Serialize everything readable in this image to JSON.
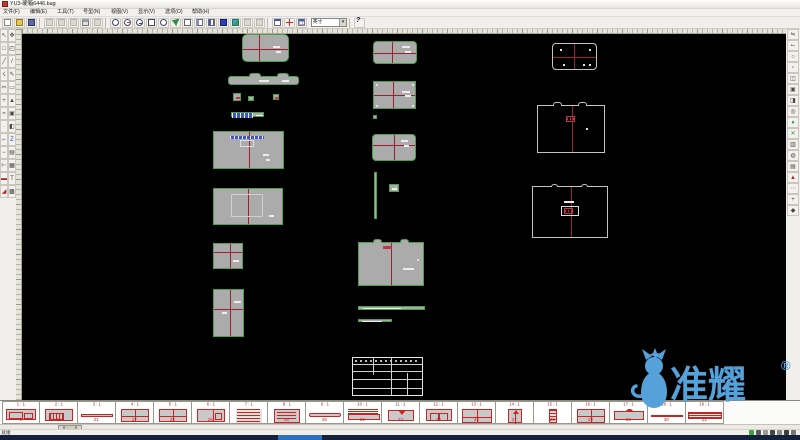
{
  "window": {
    "title": "YU3-硬箱6446.bag"
  },
  "menu": {
    "items": [
      "文件(F)",
      "编辑(E)",
      "工具(T)",
      "号型(N)",
      "视图(V)",
      "显示(V)",
      "选项(O)",
      "帮助(H)"
    ]
  },
  "toolbar": {
    "unit_value": "英寸",
    "buttons": [
      {
        "s": "i-page",
        "n": "new-file-icon"
      },
      {
        "s": "i-folder",
        "n": "open-file-icon"
      },
      {
        "s": "i-floppy",
        "n": "save-file-icon"
      },
      {
        "sep": true
      },
      {
        "s": "i-gray",
        "n": "cut-icon"
      },
      {
        "s": "i-gray",
        "n": "copy-icon"
      },
      {
        "s": "i-gray",
        "n": "paste-icon"
      },
      {
        "s": "i-print",
        "n": "print-icon"
      },
      {
        "s": "i-gray",
        "n": "undo-icon"
      },
      {
        "sep": true
      },
      {
        "s": "i-mag",
        "n": "zoom-icon"
      },
      {
        "s": "i-magp",
        "n": "zoom-in-icon"
      },
      {
        "s": "i-magm",
        "n": "zoom-out-icon"
      },
      {
        "s": "i-magw",
        "n": "zoom-window-icon"
      },
      {
        "s": "i-mag",
        "n": "zoom-all-icon"
      },
      {
        "s": "i-green",
        "n": "pan-icon"
      },
      {
        "s": "i-frame",
        "n": "frame-view-icon"
      },
      {
        "s": "i-frame2",
        "n": "split-view-icon"
      },
      {
        "s": "i-cols",
        "n": "columns-view-icon"
      },
      {
        "s": "i-blue",
        "n": "fill-view-icon"
      },
      {
        "s": "i-pic",
        "n": "layer-view-icon"
      },
      {
        "s": "i-gray",
        "n": "disabled-tool-icon"
      },
      {
        "s": "i-gray",
        "n": "disabled-tool2-icon"
      },
      {
        "sep": true
      },
      {
        "s": "i-win",
        "n": "new-window-icon"
      },
      {
        "s": "i-plus",
        "n": "add-mark-icon"
      },
      {
        "s": "i-grid",
        "n": "size-table-icon"
      }
    ]
  },
  "left_toolbar": {
    "icons": [
      "↖",
      "✥",
      "□",
      "◰",
      "╱",
      "/",
      "☇",
      "✎",
      "✂",
      "▭",
      "+",
      "▲",
      "≈",
      "▣",
      "·",
      "◧",
      "⌐",
      "Z",
      "−",
      "▤",
      "⊢",
      "▦",
      "▬",
      "T",
      "◢",
      "▩"
    ]
  },
  "right_toolbar": {
    "icons": [
      "≒",
      "⌙",
      "○",
      "▫",
      "◫",
      "▣",
      "◨",
      "◎",
      "♦",
      "✕",
      "▥",
      "◍",
      "▤",
      "▲",
      "⋯",
      "+",
      "◆"
    ]
  },
  "canvas": {
    "pieces": [
      {
        "name": "piece-lid-top",
        "kind": "filled",
        "x": 220,
        "y": 0,
        "w": 47,
        "h": 28,
        "r": 5,
        "cross": "vh",
        "cx": 16,
        "cy": 14,
        "det": [
          {
            "t": "dash",
            "x": 30,
            "y": 11,
            "w": 7,
            "h": 2
          },
          {
            "t": "dash",
            "x": 33,
            "y": 16,
            "w": 5,
            "h": 2
          }
        ]
      },
      {
        "name": "piece-flap-strip",
        "kind": "filled",
        "x": 206,
        "y": 42,
        "w": 71,
        "h": 9,
        "r": 3,
        "cross": "",
        "det": [
          {
            "t": "bump",
            "x": 20,
            "y": -4,
            "w": 12,
            "h": 4
          },
          {
            "t": "bump",
            "x": 48,
            "y": -4,
            "w": 12,
            "h": 4
          },
          {
            "t": "dash",
            "x": 30,
            "y": 3,
            "w": 10,
            "h": 2
          },
          {
            "t": "dash",
            "x": 53,
            "y": 3,
            "w": 7,
            "h": 2
          }
        ]
      },
      {
        "name": "piece-small-1",
        "kind": "filled",
        "x": 211,
        "y": 59,
        "w": 8,
        "h": 8,
        "r": 0,
        "cross": "",
        "det": [
          {
            "t": "reddash",
            "x": 2,
            "y": 3,
            "w": 4,
            "h": 2
          }
        ]
      },
      {
        "name": "piece-small-2",
        "kind": "filled",
        "x": 226,
        "y": 62,
        "w": 6,
        "h": 5,
        "r": 0,
        "cross": "",
        "det": []
      },
      {
        "name": "piece-small-3",
        "kind": "filled",
        "x": 251,
        "y": 60,
        "w": 6,
        "h": 6,
        "r": 0,
        "cross": "",
        "det": [
          {
            "t": "reddash",
            "x": 1,
            "y": 2,
            "w": 3,
            "h": 2
          }
        ]
      },
      {
        "name": "piece-label-bar",
        "kind": "filled",
        "x": 209,
        "y": 78,
        "w": 33,
        "h": 5,
        "r": 0,
        "cross": "",
        "det": [
          {
            "t": "bluebar",
            "x": 0,
            "y": 0,
            "w": 21,
            "h": 5
          },
          {
            "t": "dash",
            "x": 24,
            "y": 2,
            "w": 7,
            "h": 1
          }
        ]
      },
      {
        "name": "piece-body-front",
        "kind": "filled",
        "x": 191,
        "y": 97,
        "w": 71,
        "h": 38,
        "r": 0,
        "cross": "v",
        "cx": 35,
        "cy": 0,
        "det": [
          {
            "t": "bluebar",
            "x": 16,
            "y": 4,
            "w": 34,
            "h": 3
          },
          {
            "t": "whitebox",
            "x": 26,
            "y": 8,
            "w": 14,
            "h": 7
          },
          {
            "t": "dash",
            "x": 49,
            "y": 22,
            "w": 6,
            "h": 2
          },
          {
            "t": "dash",
            "x": 52,
            "y": 27,
            "w": 4,
            "h": 2
          }
        ]
      },
      {
        "name": "piece-body-back",
        "kind": "filled",
        "x": 191,
        "y": 154,
        "w": 70,
        "h": 37,
        "r": 0,
        "cross": "v",
        "cx": 34,
        "cy": 0,
        "det": [
          {
            "t": "innerrect",
            "x": 17,
            "y": 5,
            "w": 32,
            "h": 23
          },
          {
            "t": "dash",
            "x": 55,
            "y": 26,
            "w": 5,
            "h": 2
          }
        ]
      },
      {
        "name": "piece-side-small",
        "kind": "filled",
        "x": 191,
        "y": 209,
        "w": 30,
        "h": 26,
        "r": 0,
        "cross": "vh",
        "cx": 16,
        "cy": 8,
        "det": [
          {
            "t": "dash",
            "x": 19,
            "y": 16,
            "w": 6,
            "h": 2
          }
        ]
      },
      {
        "name": "piece-side-tall",
        "kind": "filled",
        "x": 191,
        "y": 255,
        "w": 31,
        "h": 48,
        "r": 0,
        "cross": "vh",
        "cx": 16,
        "cy": 19,
        "det": [
          {
            "t": "dash",
            "x": 20,
            "y": 11,
            "w": 7,
            "h": 2
          },
          {
            "t": "dash",
            "x": 8,
            "y": 22,
            "w": 5,
            "h": 2
          }
        ]
      },
      {
        "name": "piece-mid-lid",
        "kind": "filled",
        "x": 351,
        "y": 7,
        "w": 44,
        "h": 23,
        "r": 4,
        "cross": "vh",
        "cx": 18,
        "cy": 11,
        "det": [
          {
            "t": "dash",
            "x": 28,
            "y": 4,
            "w": 8,
            "h": 2
          },
          {
            "t": "dash",
            "x": 31,
            "y": 9,
            "w": 6,
            "h": 2
          }
        ]
      },
      {
        "name": "piece-mid-panel",
        "kind": "filled",
        "x": 351,
        "y": 47,
        "w": 43,
        "h": 28,
        "r": 0,
        "cross": "vh",
        "cx": 19,
        "cy": 13,
        "det": [
          {
            "t": "dash",
            "x": 28,
            "y": 9,
            "w": 8,
            "h": 2
          },
          {
            "t": "dash",
            "x": 31,
            "y": 13,
            "w": 6,
            "h": 2
          },
          {
            "t": "dot",
            "x": 2,
            "y": 2,
            "w": 2,
            "h": 2
          },
          {
            "t": "dot",
            "x": 38,
            "y": 2,
            "w": 2,
            "h": 2
          },
          {
            "t": "dot",
            "x": 2,
            "y": 23,
            "w": 2,
            "h": 2
          },
          {
            "t": "dot",
            "x": 38,
            "y": 23,
            "w": 2,
            "h": 2
          }
        ]
      },
      {
        "name": "piece-tiny-square",
        "kind": "filled",
        "x": 351,
        "y": 81,
        "w": 4,
        "h": 4,
        "r": 0,
        "cross": "",
        "det": []
      },
      {
        "name": "piece-mid-lid2",
        "kind": "filled",
        "x": 350,
        "y": 100,
        "w": 44,
        "h": 27,
        "r": 4,
        "cross": "vh",
        "cx": 21,
        "cy": 10,
        "det": [
          {
            "t": "dash",
            "x": 28,
            "y": 5,
            "w": 7,
            "h": 2
          },
          {
            "t": "dash",
            "x": 31,
            "y": 10,
            "w": 5,
            "h": 2
          }
        ]
      },
      {
        "name": "piece-thin-vertical",
        "kind": "filled",
        "x": 352,
        "y": 138,
        "w": 3,
        "h": 47,
        "r": 0,
        "cross": "",
        "det": []
      },
      {
        "name": "piece-tiny-tab",
        "kind": "filled",
        "x": 367,
        "y": 150,
        "w": 10,
        "h": 8,
        "r": 0,
        "cross": "",
        "det": [
          {
            "t": "dash",
            "x": 2,
            "y": 3,
            "w": 5,
            "h": 2
          }
        ]
      },
      {
        "name": "piece-gusset",
        "kind": "filled",
        "x": 336,
        "y": 208,
        "w": 66,
        "h": 44,
        "r": 0,
        "cross": "v",
        "cx": 32,
        "cy": 0,
        "det": [
          {
            "t": "bump",
            "x": 14,
            "y": -4,
            "w": 9,
            "h": 4
          },
          {
            "t": "bump",
            "x": 41,
            "y": -4,
            "w": 9,
            "h": 4
          },
          {
            "t": "reddash",
            "x": 24,
            "y": 3,
            "w": 9,
            "h": 3
          },
          {
            "t": "dash",
            "x": 44,
            "y": 25,
            "w": 11,
            "h": 2
          },
          {
            "t": "dot",
            "x": 58,
            "y": 16,
            "w": 2,
            "h": 2
          }
        ]
      },
      {
        "name": "piece-long-strip",
        "kind": "filled",
        "x": 336,
        "y": 272,
        "w": 67,
        "h": 4,
        "r": 0,
        "cross": "",
        "det": [
          {
            "t": "dash",
            "x": 4,
            "y": 1,
            "w": 38,
            "h": 1
          }
        ]
      },
      {
        "name": "piece-short-strip",
        "kind": "filled",
        "x": 336,
        "y": 285,
        "w": 34,
        "h": 3,
        "r": 0,
        "cross": "",
        "det": [
          {
            "t": "dash",
            "x": 3,
            "y": 1,
            "w": 20,
            "h": 1
          }
        ]
      },
      {
        "name": "title-block",
        "kind": "tblock",
        "x": 330,
        "y": 323,
        "w": 71,
        "h": 39,
        "r": 0,
        "cross": "",
        "det": []
      },
      {
        "name": "piece-outline-lid",
        "kind": "outline",
        "x": 530,
        "y": 9,
        "w": 45,
        "h": 27,
        "r": 4,
        "cross": "vh",
        "cx": 21,
        "cy": 13,
        "det": [
          {
            "t": "dot",
            "x": 7,
            "y": 5,
            "w": 2,
            "h": 2
          },
          {
            "t": "dot",
            "x": 36,
            "y": 5,
            "w": 2,
            "h": 2
          },
          {
            "t": "dot",
            "x": 10,
            "y": 20,
            "w": 2,
            "h": 2
          },
          {
            "t": "dot",
            "x": 30,
            "y": 20,
            "w": 2,
            "h": 2
          },
          {
            "t": "dot",
            "x": 36,
            "y": 20,
            "w": 2,
            "h": 2
          }
        ]
      },
      {
        "name": "piece-outline-box1",
        "kind": "outline",
        "x": 515,
        "y": 71,
        "w": 68,
        "h": 48,
        "r": 0,
        "cross": "v",
        "cx": 34,
        "cy": 0,
        "det": [
          {
            "t": "obump",
            "x": 15,
            "y": -4,
            "w": 9,
            "h": 4
          },
          {
            "t": "obump",
            "x": 40,
            "y": -4,
            "w": 9,
            "h": 4
          },
          {
            "t": "redbox",
            "x": 28,
            "y": 10,
            "w": 9,
            "h": 6
          },
          {
            "t": "dot",
            "x": 48,
            "y": 22,
            "w": 2,
            "h": 2
          }
        ]
      },
      {
        "name": "piece-outline-box2",
        "kind": "outline",
        "x": 510,
        "y": 152,
        "w": 76,
        "h": 52,
        "r": 0,
        "cross": "v",
        "cx": 38,
        "cy": 0,
        "det": [
          {
            "t": "obump",
            "x": 18,
            "y": -3,
            "w": 7,
            "h": 3
          },
          {
            "t": "obump",
            "x": 48,
            "y": -3,
            "w": 7,
            "h": 3
          },
          {
            "t": "dash",
            "x": 31,
            "y": 14,
            "w": 10,
            "h": 2
          },
          {
            "t": "whitebox",
            "x": 28,
            "y": 19,
            "w": 18,
            "h": 10
          },
          {
            "t": "redbox",
            "x": 31,
            "y": 21,
            "w": 9,
            "h": 6
          }
        ]
      }
    ]
  },
  "pattern_bar": {
    "cells": [
      {
        "label": "1 : 1",
        "count": "9",
        "thumb": "t-inner"
      },
      {
        "label": "2 : 1",
        "count": "16",
        "thumb": "t-inner2"
      },
      {
        "label": "3 : 1",
        "count": "21",
        "thumb": "t-strip"
      },
      {
        "label": "4 : 1",
        "count": "27",
        "thumb": "t-grid"
      },
      {
        "label": "5 : 1",
        "count": "22",
        "thumb": "t-grid"
      },
      {
        "label": "6 : 1",
        "count": "26",
        "thumb": "t-side"
      },
      {
        "label": "7 : 1",
        "count": "",
        "thumb": "t-text"
      },
      {
        "label": "8 : 1",
        "count": "25",
        "thumb": "t-textrect"
      },
      {
        "label": "9 : 1",
        "count": "26",
        "thumb": "t-flapthin"
      },
      {
        "label": "10 : 1",
        "count": "21",
        "thumb": "t-bartext"
      },
      {
        "label": "11 : 1",
        "count": "22",
        "thumb": "t-notch"
      },
      {
        "label": "12 : 1",
        "count": "23",
        "thumb": "t-sq2"
      },
      {
        "label": "13 : 1",
        "count": "24",
        "thumb": "t-big"
      },
      {
        "label": "14 : 1",
        "count": "27",
        "thumb": "t-arrow"
      },
      {
        "label": "15 : 1",
        "count": "25",
        "thumb": "t-tallbar"
      },
      {
        "label": "16 : 1",
        "count": "23",
        "thumb": "t-cross"
      },
      {
        "label": "17 : 1",
        "count": "26",
        "thumb": "t-bump"
      },
      {
        "label": "18 : 1",
        "count": "30",
        "thumb": "t-line"
      },
      {
        "label": "19 : 1",
        "count": "31",
        "thumb": "t-stripes"
      }
    ]
  },
  "status": {
    "ready": "就绪",
    "tray_colors": [
      "#3aa63a",
      "#5a5a5a",
      "#9a9a9a",
      "#444444",
      "#888888",
      "#3c3c3c",
      "#777777"
    ]
  },
  "watermark": {
    "text": "准耀",
    "reg": "®",
    "color": "#55a1da"
  },
  "colors": {
    "piece_fill": "#ababab",
    "piece_outline_green": "#49a049",
    "crosshair_red": "#9b2030",
    "thumb_red": "#cc2222",
    "highlight_blue": "#3c55c8",
    "taskbar": "#14213d",
    "taskbar_accent": "#2f6fc2"
  }
}
